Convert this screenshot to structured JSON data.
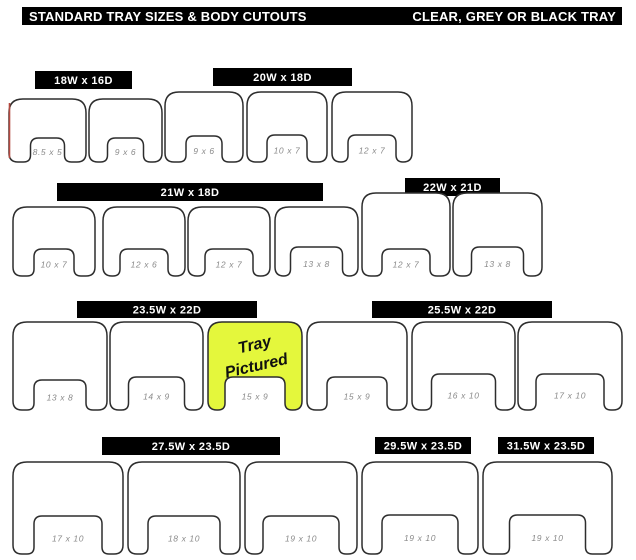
{
  "title_bar": {
    "left": "STANDARD TRAY SIZES & BODY CUTOUTS",
    "right": "CLEAR, GREY OR BLACK TRAY"
  },
  "colors": {
    "bar_bg": "#000000",
    "bar_fg": "#ffffff",
    "tray_outline": "#2d2d2d",
    "tray_fill": "#ffffff",
    "label_gray": "#8a8a8a",
    "highlight_fill": "#e4f73c",
    "artifact_red": "#b2483f"
  },
  "highlight_note": {
    "line1": "Tray",
    "line2": "Pictured"
  },
  "groups": [
    {
      "header": "18W x 16D",
      "header_box": {
        "x": 35,
        "y": 71,
        "w": 97,
        "h": 18
      },
      "trays": [
        {
          "label": "8.5 x 5",
          "x": 9,
          "y": 99,
          "w": 77,
          "h": 63,
          "nw": 34,
          "nh": 24,
          "red_edge": true
        },
        {
          "label": "9 x 6",
          "x": 89,
          "y": 99,
          "w": 73,
          "h": 63,
          "nw": 36,
          "nh": 24
        }
      ]
    },
    {
      "header": "20W x 18D",
      "header_box": {
        "x": 213,
        "y": 68,
        "w": 139,
        "h": 18
      },
      "trays": [
        {
          "label": "9 x 6",
          "x": 165,
          "y": 92,
          "w": 78,
          "h": 70,
          "nw": 36,
          "nh": 26
        },
        {
          "label": "10 x 7",
          "x": 247,
          "y": 92,
          "w": 80,
          "h": 70,
          "nw": 40,
          "nh": 27
        },
        {
          "label": "12 x 7",
          "x": 332,
          "y": 92,
          "w": 80,
          "h": 70,
          "nw": 48,
          "nh": 27
        }
      ]
    },
    {
      "header": "21W x 18D",
      "header_box": {
        "x": 57,
        "y": 183,
        "w": 266,
        "h": 18
      },
      "trays": [
        {
          "label": "10 x 7",
          "x": 13,
          "y": 207,
          "w": 82,
          "h": 69,
          "nw": 40,
          "nh": 27
        },
        {
          "label": "12 x 6",
          "x": 103,
          "y": 207,
          "w": 82,
          "h": 69,
          "nw": 48,
          "nh": 27
        },
        {
          "label": "12 x 7",
          "x": 188,
          "y": 207,
          "w": 82,
          "h": 69,
          "nw": 48,
          "nh": 27
        },
        {
          "label": "13 x 8",
          "x": 275,
          "y": 207,
          "w": 83,
          "h": 69,
          "nw": 52,
          "nh": 29
        }
      ]
    },
    {
      "header": "22W x 21D",
      "header_box": {
        "x": 405,
        "y": 178,
        "w": 95,
        "h": 18
      },
      "trays": [
        {
          "label": "12 x 7",
          "x": 362,
          "y": 193,
          "w": 88,
          "h": 83,
          "nw": 48,
          "nh": 27
        },
        {
          "label": "13 x 8",
          "x": 453,
          "y": 193,
          "w": 89,
          "h": 83,
          "nw": 52,
          "nh": 29
        }
      ]
    },
    {
      "header": "23.5W x 22D",
      "header_box": {
        "x": 77,
        "y": 301,
        "w": 180,
        "h": 17
      },
      "trays": [
        {
          "label": "13 x 8",
          "x": 13,
          "y": 322,
          "w": 94,
          "h": 88,
          "nw": 52,
          "nh": 30
        },
        {
          "label": "14 x 9",
          "x": 110,
          "y": 322,
          "w": 93,
          "h": 88,
          "nw": 56,
          "nh": 33
        },
        {
          "label": "15 x 9",
          "x": 208,
          "y": 322,
          "w": 94,
          "h": 88,
          "nw": 60,
          "nh": 33,
          "highlight": true
        }
      ]
    },
    {
      "header": "25.5W x 22D",
      "header_box": {
        "x": 372,
        "y": 301,
        "w": 180,
        "h": 17
      },
      "trays": [
        {
          "label": "15 x 9",
          "x": 307,
          "y": 322,
          "w": 100,
          "h": 88,
          "nw": 60,
          "nh": 33
        },
        {
          "label": "16 x 10",
          "x": 412,
          "y": 322,
          "w": 103,
          "h": 88,
          "nw": 64,
          "nh": 36
        },
        {
          "label": "17 x 10",
          "x": 518,
          "y": 322,
          "w": 104,
          "h": 88,
          "nw": 68,
          "nh": 36
        }
      ]
    },
    {
      "header": "27.5W x 23.5D",
      "header_box": {
        "x": 102,
        "y": 437,
        "w": 178,
        "h": 18
      },
      "trays": [
        {
          "label": "17 x 10",
          "x": 13,
          "y": 462,
          "w": 110,
          "h": 92,
          "nw": 68,
          "nh": 38
        },
        {
          "label": "18 x 10",
          "x": 128,
          "y": 462,
          "w": 112,
          "h": 92,
          "nw": 72,
          "nh": 38
        },
        {
          "label": "19 x 10",
          "x": 245,
          "y": 462,
          "w": 112,
          "h": 92,
          "nw": 76,
          "nh": 38
        }
      ]
    },
    {
      "header": "29.5W x 23.5D",
      "header_box": {
        "x": 375,
        "y": 437,
        "w": 96,
        "h": 17
      },
      "trays": [
        {
          "label": "19 x 10",
          "x": 362,
          "y": 462,
          "w": 116,
          "h": 92,
          "nw": 76,
          "nh": 39
        }
      ]
    },
    {
      "header": "31.5W x 23.5D",
      "header_box": {
        "x": 498,
        "y": 437,
        "w": 96,
        "h": 17
      },
      "trays": [
        {
          "label": "19 x 10",
          "x": 483,
          "y": 462,
          "w": 129,
          "h": 92,
          "nw": 76,
          "nh": 39
        }
      ]
    }
  ]
}
